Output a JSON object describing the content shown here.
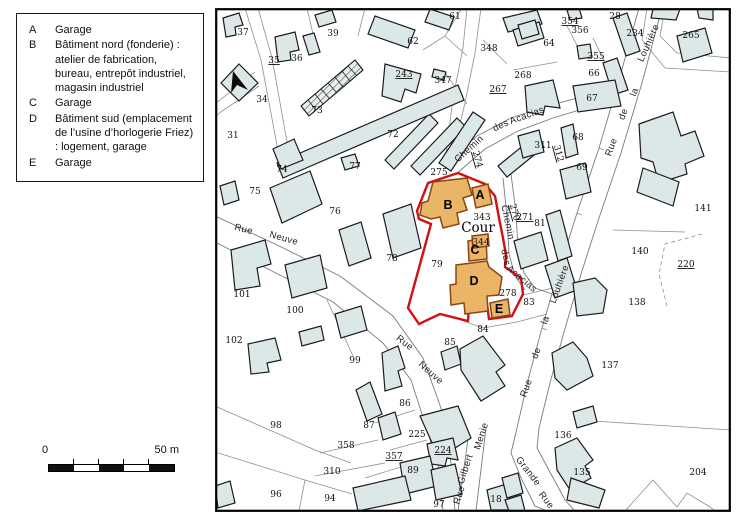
{
  "legend": {
    "items": [
      {
        "key": "A",
        "text": "Garage"
      },
      {
        "key": "B",
        "text": "Bâtiment nord (fonderie) : atelier de fabrication, bureau, entrepôt industriel, magasin industriel"
      },
      {
        "key": "C",
        "text": "Garage"
      },
      {
        "key": "D",
        "text": "Bâtiment sud (emplacement de l’usine d’horlogerie Friez) : logement, garage"
      },
      {
        "key": "E",
        "text": "Garage"
      }
    ]
  },
  "scale_bar": {
    "start": "0",
    "end": "50 m"
  },
  "map": {
    "colors": {
      "building_fill": "#dce8e8",
      "building_stroke": "#1c1c1c",
      "highlight_fill": "#eab566",
      "highlight_stroke": "#8a4513",
      "boundary_red": "#d40f12",
      "parcel_line": "#8f8f8f",
      "street_line": "#7a7a7a"
    },
    "building_letters": [
      {
        "text": "A",
        "x": 265,
        "y": 191
      },
      {
        "text": "B",
        "x": 233,
        "y": 201
      },
      {
        "text": "C",
        "x": 260,
        "y": 246
      },
      {
        "text": "D",
        "x": 259,
        "y": 277
      },
      {
        "text": "E",
        "x": 284,
        "y": 305
      }
    ],
    "area_labels": [
      {
        "text": "Cour",
        "x": 263,
        "y": 224
      }
    ],
    "parcel_numbers": [
      {
        "text": "37",
        "x": 28,
        "y": 27
      },
      {
        "text": "39",
        "x": 118,
        "y": 28
      },
      {
        "text": "35",
        "x": 59,
        "y": 55,
        "u": true
      },
      {
        "text": "36",
        "x": 82,
        "y": 53
      },
      {
        "text": "34",
        "x": 47,
        "y": 94
      },
      {
        "text": "31",
        "x": 18,
        "y": 130
      },
      {
        "text": "73",
        "x": 102,
        "y": 105
      },
      {
        "text": "74",
        "x": 67,
        "y": 164
      },
      {
        "text": "77",
        "x": 140,
        "y": 161
      },
      {
        "text": "72",
        "x": 178,
        "y": 129
      },
      {
        "text": "62",
        "x": 198,
        "y": 36
      },
      {
        "text": "61",
        "x": 240,
        "y": 11
      },
      {
        "text": "243",
        "x": 189,
        "y": 69,
        "u": true
      },
      {
        "text": "347",
        "x": 228,
        "y": 75
      },
      {
        "text": "348",
        "x": 274,
        "y": 43
      },
      {
        "text": "354",
        "x": 355,
        "y": 16,
        "u": true
      },
      {
        "text": "356",
        "x": 365,
        "y": 25
      },
      {
        "text": "28",
        "x": 400,
        "y": 11
      },
      {
        "text": "234",
        "x": 420,
        "y": 28
      },
      {
        "text": "265",
        "x": 476,
        "y": 30
      },
      {
        "text": "64",
        "x": 334,
        "y": 38
      },
      {
        "text": "355",
        "x": 381,
        "y": 51,
        "u": true
      },
      {
        "text": "66",
        "x": 379,
        "y": 68
      },
      {
        "text": "268",
        "x": 308,
        "y": 70
      },
      {
        "text": "267",
        "x": 283,
        "y": 84,
        "u": true
      },
      {
        "text": "67",
        "x": 377,
        "y": 93
      },
      {
        "text": "68",
        "x": 363,
        "y": 132
      },
      {
        "text": "311",
        "x": 328,
        "y": 140
      },
      {
        "text": "312",
        "x": 341,
        "y": 146,
        "u": true,
        "rot": 75
      },
      {
        "text": "69",
        "x": 367,
        "y": 162
      },
      {
        "text": "75",
        "x": 40,
        "y": 186
      },
      {
        "text": "76",
        "x": 120,
        "y": 206
      },
      {
        "text": "78",
        "x": 177,
        "y": 253
      },
      {
        "text": "101",
        "x": 27,
        "y": 289
      },
      {
        "text": "100",
        "x": 80,
        "y": 305
      },
      {
        "text": "102",
        "x": 19,
        "y": 335
      },
      {
        "text": "99",
        "x": 140,
        "y": 355
      },
      {
        "text": "275",
        "x": 224,
        "y": 167
      },
      {
        "text": "343",
        "x": 267,
        "y": 212
      },
      {
        "text": "344",
        "x": 266,
        "y": 237,
        "s": 7
      },
      {
        "text": "79",
        "x": 222,
        "y": 259
      },
      {
        "text": "278",
        "x": 293,
        "y": 288
      },
      {
        "text": "81",
        "x": 325,
        "y": 218
      },
      {
        "text": "270",
        "x": 297,
        "y": 205,
        "u": true,
        "rot": 75
      },
      {
        "text": "271",
        "x": 310,
        "y": 212,
        "u": true
      },
      {
        "text": "274",
        "x": 260,
        "y": 152,
        "u": true,
        "rot": 75
      },
      {
        "text": "83",
        "x": 314,
        "y": 297
      },
      {
        "text": "84",
        "x": 268,
        "y": 324
      },
      {
        "text": "85",
        "x": 235,
        "y": 337
      },
      {
        "text": "86",
        "x": 190,
        "y": 398
      },
      {
        "text": "87",
        "x": 154,
        "y": 420
      },
      {
        "text": "225",
        "x": 202,
        "y": 429
      },
      {
        "text": "224",
        "x": 228,
        "y": 445,
        "u": true
      },
      {
        "text": "358",
        "x": 131,
        "y": 440
      },
      {
        "text": "357",
        "x": 179,
        "y": 451,
        "u": true
      },
      {
        "text": "310",
        "x": 117,
        "y": 466
      },
      {
        "text": "94",
        "x": 115,
        "y": 493
      },
      {
        "text": "96",
        "x": 61,
        "y": 489
      },
      {
        "text": "98",
        "x": 61,
        "y": 420
      },
      {
        "text": "89",
        "x": 198,
        "y": 465
      },
      {
        "text": "18",
        "x": 281,
        "y": 494
      },
      {
        "text": "97",
        "x": 224,
        "y": 499,
        "s": 8
      },
      {
        "text": "137",
        "x": 395,
        "y": 360
      },
      {
        "text": "136",
        "x": 348,
        "y": 430
      },
      {
        "text": "135",
        "x": 367,
        "y": 467
      },
      {
        "text": "204",
        "x": 483,
        "y": 467
      },
      {
        "text": "141",
        "x": 488,
        "y": 203
      },
      {
        "text": "140",
        "x": 425,
        "y": 246
      },
      {
        "text": "220",
        "x": 471,
        "y": 259,
        "u": true
      },
      {
        "text": "138",
        "x": 422,
        "y": 297
      }
    ],
    "street_names": [
      {
        "text": "Rue",
        "x": 28,
        "y": 224,
        "rot": 14
      },
      {
        "text": "Neuve",
        "x": 68,
        "y": 233,
        "rot": 16
      },
      {
        "text": "Rue",
        "x": 188,
        "y": 337,
        "rot": 38
      },
      {
        "text": "Neuve",
        "x": 214,
        "y": 367,
        "rot": 42
      },
      {
        "text": "Chemin",
        "x": 256,
        "y": 143,
        "rot": -42
      },
      {
        "text": "des",
        "x": 287,
        "y": 120,
        "rot": -25
      },
      {
        "text": "Acacias",
        "x": 313,
        "y": 110,
        "rot": -20
      },
      {
        "text": "Chemin",
        "x": 290,
        "y": 215,
        "rot": 78
      },
      {
        "text": "des",
        "x": 288,
        "y": 250,
        "rot": 78
      },
      {
        "text": "Acacias",
        "x": 305,
        "y": 273,
        "rot": 40
      },
      {
        "text": "Rue",
        "x": 399,
        "y": 140,
        "rot": -70
      },
      {
        "text": "de",
        "x": 411,
        "y": 107,
        "rot": -70
      },
      {
        "text": "la",
        "x": 422,
        "y": 85,
        "rot": -70
      },
      {
        "text": "Louhière",
        "x": 436,
        "y": 36,
        "rot": -66
      },
      {
        "text": "Rue",
        "x": 314,
        "y": 381,
        "rot": -70
      },
      {
        "text": "de",
        "x": 324,
        "y": 346,
        "rot": -70
      },
      {
        "text": "la",
        "x": 333,
        "y": 313,
        "rot": -70
      },
      {
        "text": "Louhière",
        "x": 347,
        "y": 277,
        "rot": -70
      },
      {
        "text": "Rue",
        "x": 247,
        "y": 488,
        "rot": -72
      },
      {
        "text": "Gilbert",
        "x": 253,
        "y": 462,
        "rot": -72
      },
      {
        "text": "Menie",
        "x": 269,
        "y": 429,
        "rot": -72
      },
      {
        "text": "Grande",
        "x": 311,
        "y": 465,
        "rot": 52
      },
      {
        "text": "Rue",
        "x": 329,
        "y": 494,
        "rot": 52
      }
    ]
  }
}
